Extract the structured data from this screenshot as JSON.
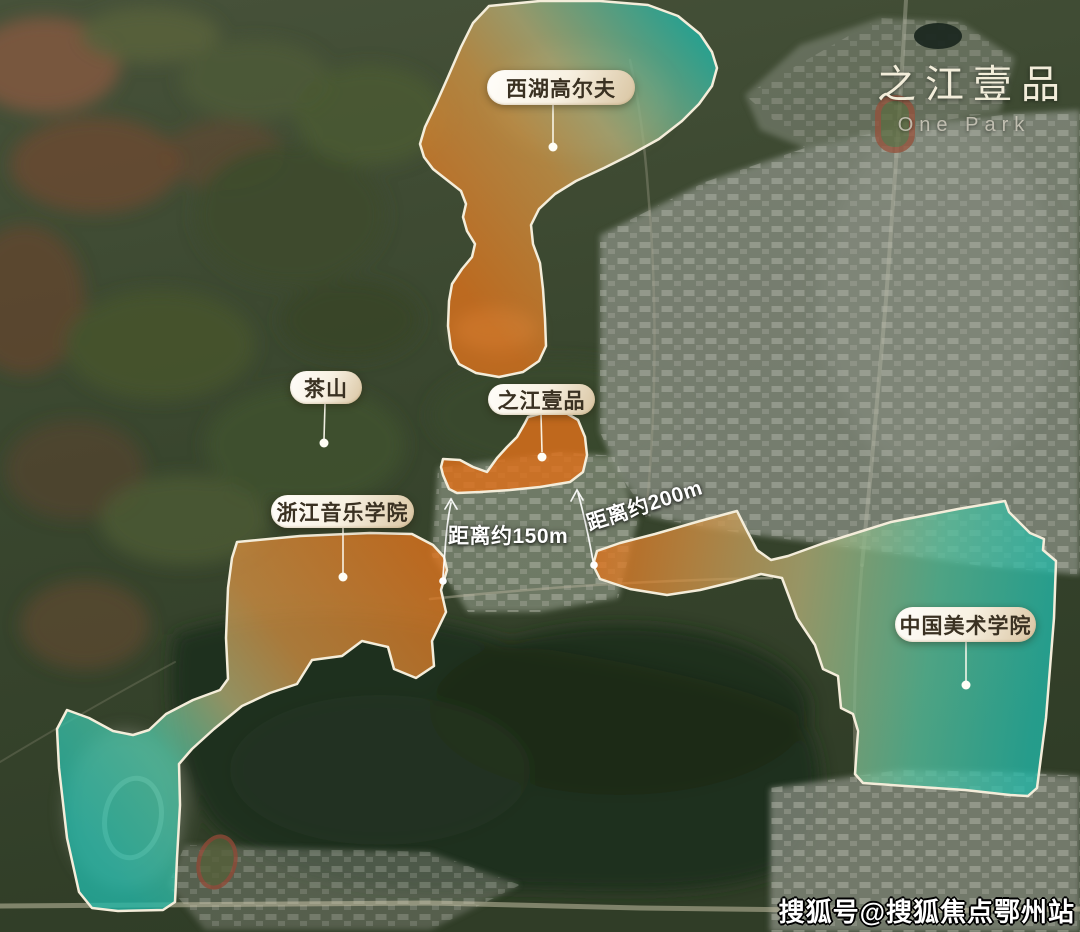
{
  "logo": {
    "title": "之江壹品",
    "subtitle": "One Park"
  },
  "labels": {
    "golf": "西湖高尔夫",
    "tea": "茶山",
    "onepark": "之江壹品",
    "music": "浙江音乐学院",
    "art": "中国美术学院"
  },
  "distances": {
    "d150": "距离约150m",
    "d200": "距离约200m"
  },
  "watermark": "搜狐号@搜狐焦点鄂州站",
  "colors": {
    "orange": "#e0731c",
    "olive": "#b3ad76",
    "teal": "#23b7a8",
    "outline": "#f4edda",
    "pill_text": "#3a3122",
    "distance_text": "#ffffff",
    "logo_title": "#f2edda",
    "logo_subtitle": "#b9b6a7"
  }
}
